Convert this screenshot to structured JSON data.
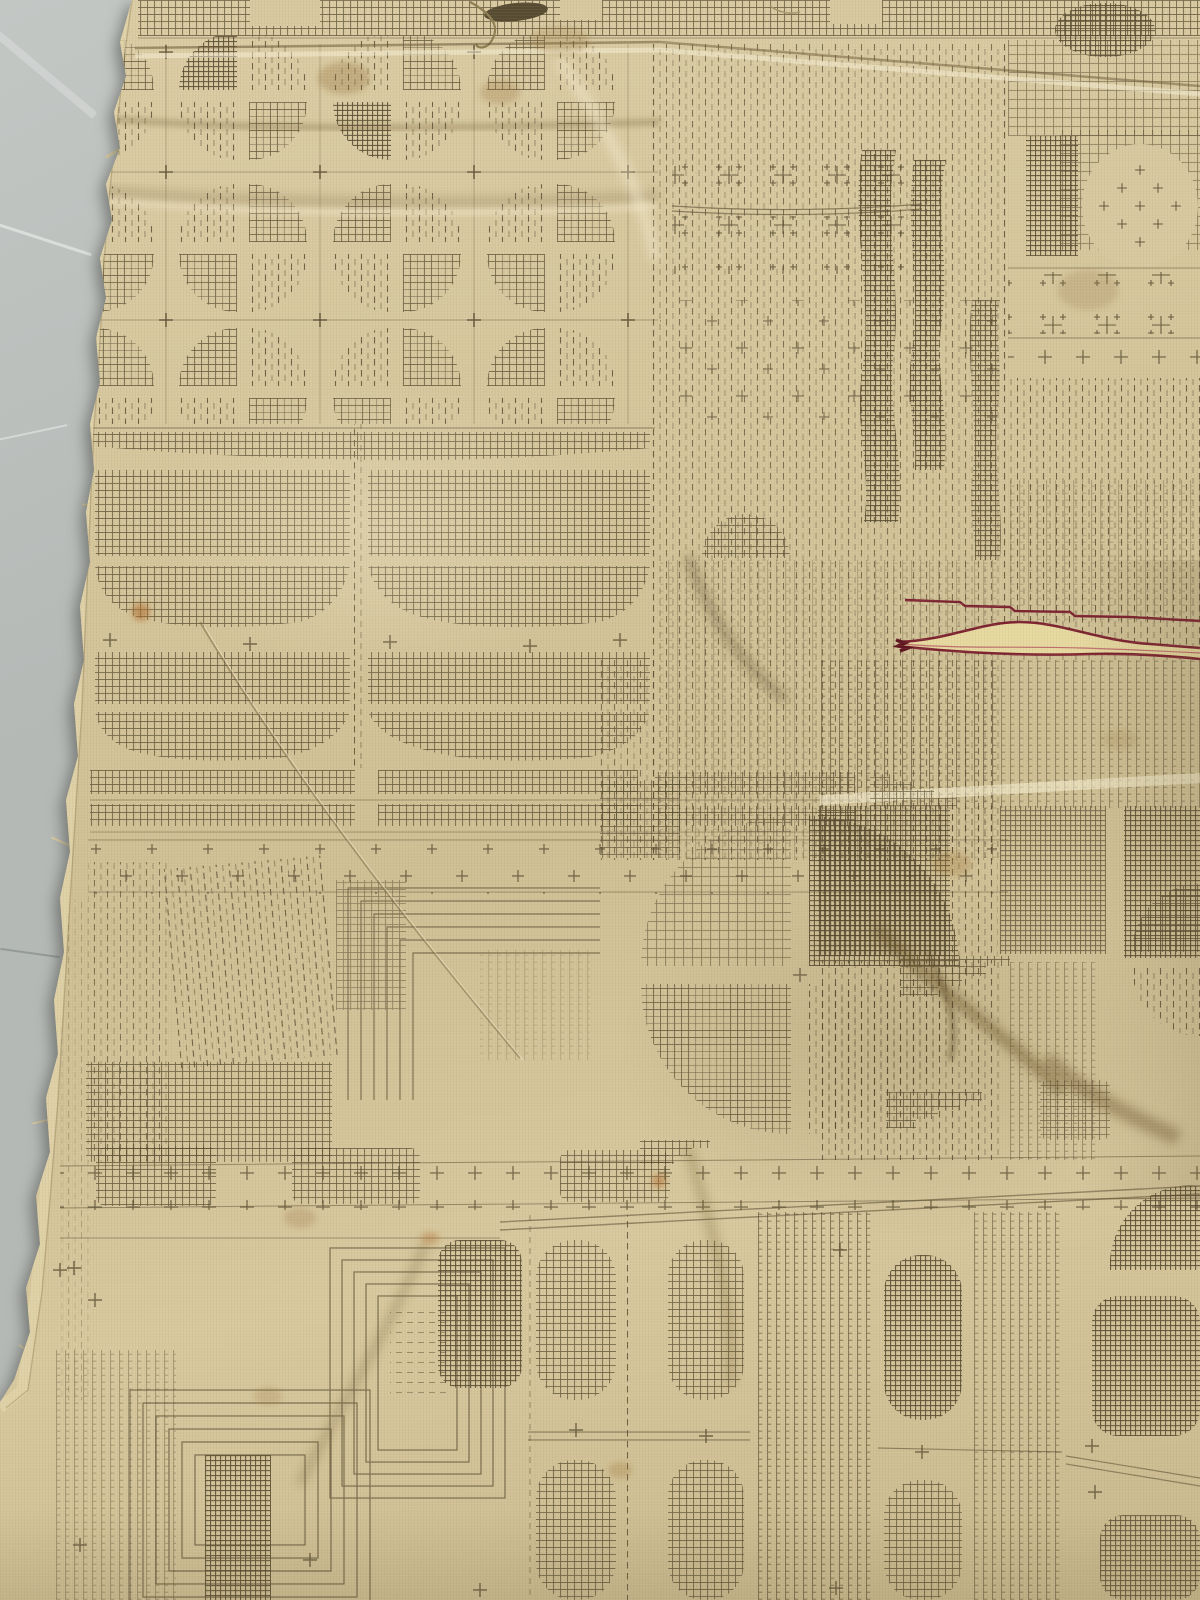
{
  "scene": {
    "type": "photograph",
    "subject": "Antique woven jacquard fabric fragment with geometric olive-brown pattern on a beige ground",
    "backdrop": "plain gray studio surface visible along frayed left edge",
    "details": [
      "frayed torn left selvage edge",
      "horizontal seam fold near the top",
      "dark red embroidered accent thread with pale lens-shaped motif at middle right",
      "scattered brown age stains",
      "soft wrinkles and diagonal creases"
    ]
  },
  "motifs": {
    "list": [
      "quatrefoil circles split into crosshatch and dashed quadrants",
      "crosshatch grid blocks",
      "awning strips with curved bottoms",
      "vertical dashed ladder stripes",
      "plus-sign cross bands",
      "diamond clusters of plus stitches under arches",
      "concentric-square maze corners",
      "columns of crosshatched ovals"
    ]
  },
  "palette": {
    "backdrop": "#b5b9b6",
    "backdrop-light": "#c3c7c4",
    "backdrop-dark": "#9ba19d",
    "base": "#d7c89f",
    "base-light": "#e4d6ae",
    "base-dark": "#c2b185",
    "ink": "#55492d",
    "ink-soft": "#6e6143",
    "red": "#7d2330",
    "red-dark": "#5f161f",
    "lens-fill": "#e6d89f",
    "stain": "#b06a28"
  }
}
